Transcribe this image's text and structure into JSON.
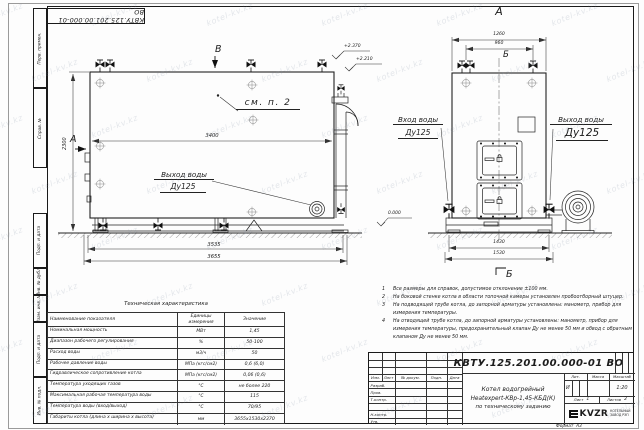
{
  "colors": {
    "line": "#1c1c1c",
    "paper": "#fdfdfd",
    "watermark": "#7d8a9e"
  },
  "watermark": {
    "text": "kotel-kv.kz"
  },
  "frame": {
    "corner_doc_number": "КВТУ.125.201.00.000-01 ВО",
    "margin_labels": {
      "perv_primen": "Перв. примен.",
      "sprav_no": "Справ. №",
      "podp_data_1": "Подп. и дата",
      "inv_dubl": "Инв. № дубл.",
      "vzam_inv": "Взам. инв. №",
      "podp_data_2": "Подп. и дата",
      "inv_podl": "Инв. № подл."
    },
    "format_label": "Формат",
    "format_value": "А3"
  },
  "drawing": {
    "main_view": {
      "mark_top": "В",
      "view_arrow_label": "А",
      "callout": "см. п. 2",
      "dims": {
        "inner_width": "3400",
        "height": "2300",
        "base": "3535",
        "overall": "3655"
      },
      "elevations": {
        "stack_top": "+2.370",
        "boiler_top": "+2.210"
      },
      "water_outlet": {
        "line1": "Выход воды",
        "line2": "Ду125"
      }
    },
    "front_view": {
      "title": "А",
      "section_mark_top": "Б",
      "section_mark_bottom": "Б",
      "dims": {
        "overall_width": "1260",
        "valve_spacing": "960",
        "base": "1430",
        "overall_base": "1530"
      },
      "elevation_zero": "0.000",
      "water_inlet": {
        "line1": "Вход воды",
        "line2": "Ду125"
      },
      "water_outlet": {
        "line1": "Выход воды",
        "line2": "Ду125"
      }
    }
  },
  "tech_table": {
    "title": "Техническая характеристика",
    "col_name": "Наименование показателя",
    "col_units": "Единицы измерения",
    "col_value": "Значение",
    "rows": [
      {
        "name": "Номинальная мощность",
        "units": "МВт",
        "value": "1,45"
      },
      {
        "name": "Диапазон рабочего регулирования",
        "units": "%",
        "value": "50-100"
      },
      {
        "name": "Расход воды",
        "units": "м3/ч",
        "value": "50"
      },
      {
        "name": "Рабочее давление воды",
        "units": "МПа (кгс/см2)",
        "value": "0,6 (6,0)"
      },
      {
        "name": "Гидравлическое сопротивление котла",
        "units": "МПа (кгс/см2)",
        "value": "0,06 (0,6)"
      },
      {
        "name": "Температура уходящих газов",
        "units": "°С",
        "value": "не более 220"
      },
      {
        "name": "Максимальная рабочая температура воды",
        "units": "°С",
        "value": "115"
      },
      {
        "name": "Температура воды (вход/выход)",
        "units": "°С",
        "value": "70/95"
      },
      {
        "name": "Габариты котла (длина х ширина х высота)",
        "units": "мм",
        "value": "3655х1530х2370"
      }
    ]
  },
  "notes": {
    "items": [
      {
        "num": "1",
        "text": "Все размеры для справок, допустимое отклонение ±100 мм."
      },
      {
        "num": "2",
        "text": "На боковой стенке котла в области топочной камеры установлен пробоотборный штуцер."
      },
      {
        "num": "3",
        "text": "На подводящей трубе котла, до запорной арматуры установлены: манометр, прибор для измерения температуры."
      },
      {
        "num": "4",
        "text": "На отводящей трубе котла, до запорной арматуры установлены: манометр, прибор для измерения температуры, предохранительный клапан Ду не менее 50 мм и обвод с обратным клапаном Ду не менее 50 мм."
      }
    ]
  },
  "title_block": {
    "doc_number": "КВТУ.125.201.00.000-01 ВО",
    "columns": {
      "izm": "Изм.",
      "list": "Лист",
      "doc": "№ докум.",
      "podp": "Подп.",
      "data": "Дата"
    },
    "signature_rows": {
      "r1": "Разраб.",
      "r2": "Пров.",
      "r3": "Т.контр.",
      "r4": "Н.контр.",
      "r5": "Утв."
    },
    "product": {
      "line1": "Котел водогрейный",
      "line2": "Heatexpert-КВр-1,45-КБД(К)",
      "line3": "по техническому заданию"
    },
    "lit": {
      "label": "Лит.",
      "value": "И"
    },
    "mass": {
      "label": "Масса",
      "value": ""
    },
    "scale": {
      "label": "Масштаб",
      "value": "1:20"
    },
    "sheet": {
      "label": "Лист",
      "value": "1"
    },
    "sheets": {
      "label": "Листов",
      "value": "2"
    },
    "logo": {
      "text": "KVZR",
      "caption1": "КОТЕЛЬНЫЙ",
      "caption2": "ЗАВОД РЭП"
    }
  }
}
